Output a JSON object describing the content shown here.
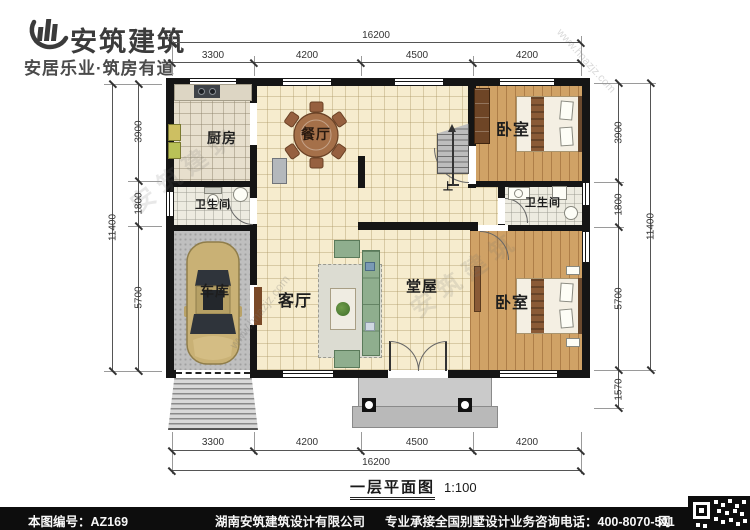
{
  "header": {
    "brand": "安筑建筑",
    "slogan": "安居乐业·筑房有道"
  },
  "plan": {
    "title": "一层平面图",
    "scale": "1:100",
    "rooms": {
      "kitchen": "厨房",
      "dining": "餐厅",
      "bedroom_top": "卧室",
      "bath_left": "卫生间",
      "bath_right": "卫生间",
      "garage": "车库",
      "living": "客厅",
      "hall": "堂屋",
      "bedroom_bottom": "卧室",
      "stair_up": "上"
    },
    "dims": {
      "top": {
        "overall": "16200",
        "seg": [
          "3300",
          "4200",
          "4500",
          "4200"
        ]
      },
      "bottom": {
        "overall": "16200",
        "seg": [
          "3300",
          "4200",
          "4500",
          "4200"
        ]
      },
      "left": {
        "overall": "11400",
        "seg": [
          "3900",
          "1800",
          "5700"
        ]
      },
      "right": {
        "overall": "11400",
        "seg": [
          "3900",
          "1800",
          "5700",
          "1570"
        ]
      }
    }
  },
  "watermark": {
    "brand": "安筑建筑",
    "url": "www.hnazjz.com"
  },
  "footer": {
    "code": "本图编号：AZ169",
    "company": "湖南安筑建筑设计有限公司",
    "service": "专业承接全国别墅设计业务",
    "phone": "咨询电话：400-8070-511",
    "web": "网"
  },
  "colors": {
    "wall": "#151515",
    "tile": "#f6ecce",
    "wood": "#d0a266",
    "concrete": "#bfbfbf",
    "car_body": "#c9b175",
    "footer_bg": "#0d0d0d"
  }
}
